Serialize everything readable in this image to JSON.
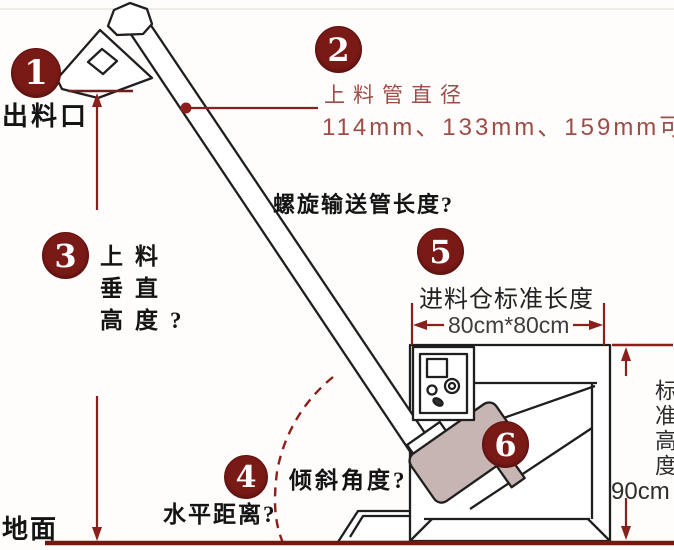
{
  "diagram": {
    "callouts": {
      "c1": {
        "num": "1",
        "label": "出料口"
      },
      "c2": {
        "num": "2",
        "title": "上料管直径",
        "detail": "114mm、133mm、159mm可"
      },
      "c3": {
        "num": "3",
        "line1": "上料",
        "line2": "垂直",
        "line3": "高度?"
      },
      "c4": {
        "num": "4",
        "label": "水平距离?",
        "angle_label": "倾斜角度?"
      },
      "c5": {
        "num": "5",
        "label": "进料仓标准长度",
        "dimension": "80cm*80cm"
      },
      "c6": {
        "num": "6"
      }
    },
    "labels": {
      "pipe_length": "螺旋输送管长度?",
      "ground": "地面",
      "height_label": "标准高度",
      "height_value": "90cm"
    },
    "colors": {
      "badge": "#7a1a17",
      "dimension_line": "#8b1f1b",
      "accent_text": "#9d4d47",
      "ink": "#1f1f1f",
      "motor_fill": "#c7b5b4",
      "ground_line": "#70190f"
    }
  }
}
